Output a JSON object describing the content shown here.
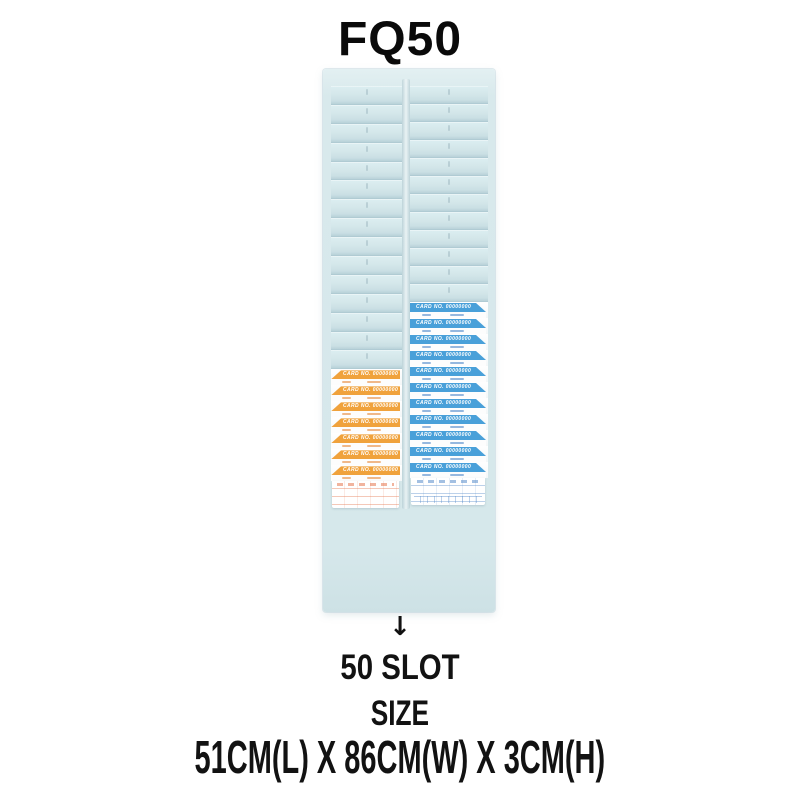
{
  "page_title": "FQ50",
  "rack": {
    "body_color": "#d7e8eb",
    "columns": [
      {
        "name": "left",
        "empty_pockets": 15,
        "pocket_height": 18.9,
        "cards": {
          "count": 7,
          "color": "#f0a23c",
          "cut_corner": "left",
          "header_text": "CARD NO. 00000000"
        }
      },
      {
        "name": "right",
        "empty_pockets": 12,
        "pocket_height": 18.0,
        "cards": {
          "count": 11,
          "color": "#49a0d9",
          "cut_corner": "right",
          "header_text": "CARD NO. 00000000"
        }
      }
    ]
  },
  "annotation": {
    "arrow_icon": "↓",
    "caption_lines": [
      "50 SLOT",
      "SIZE",
      "51CM(L) X 86CM(W) X 3CM(H)"
    ]
  }
}
